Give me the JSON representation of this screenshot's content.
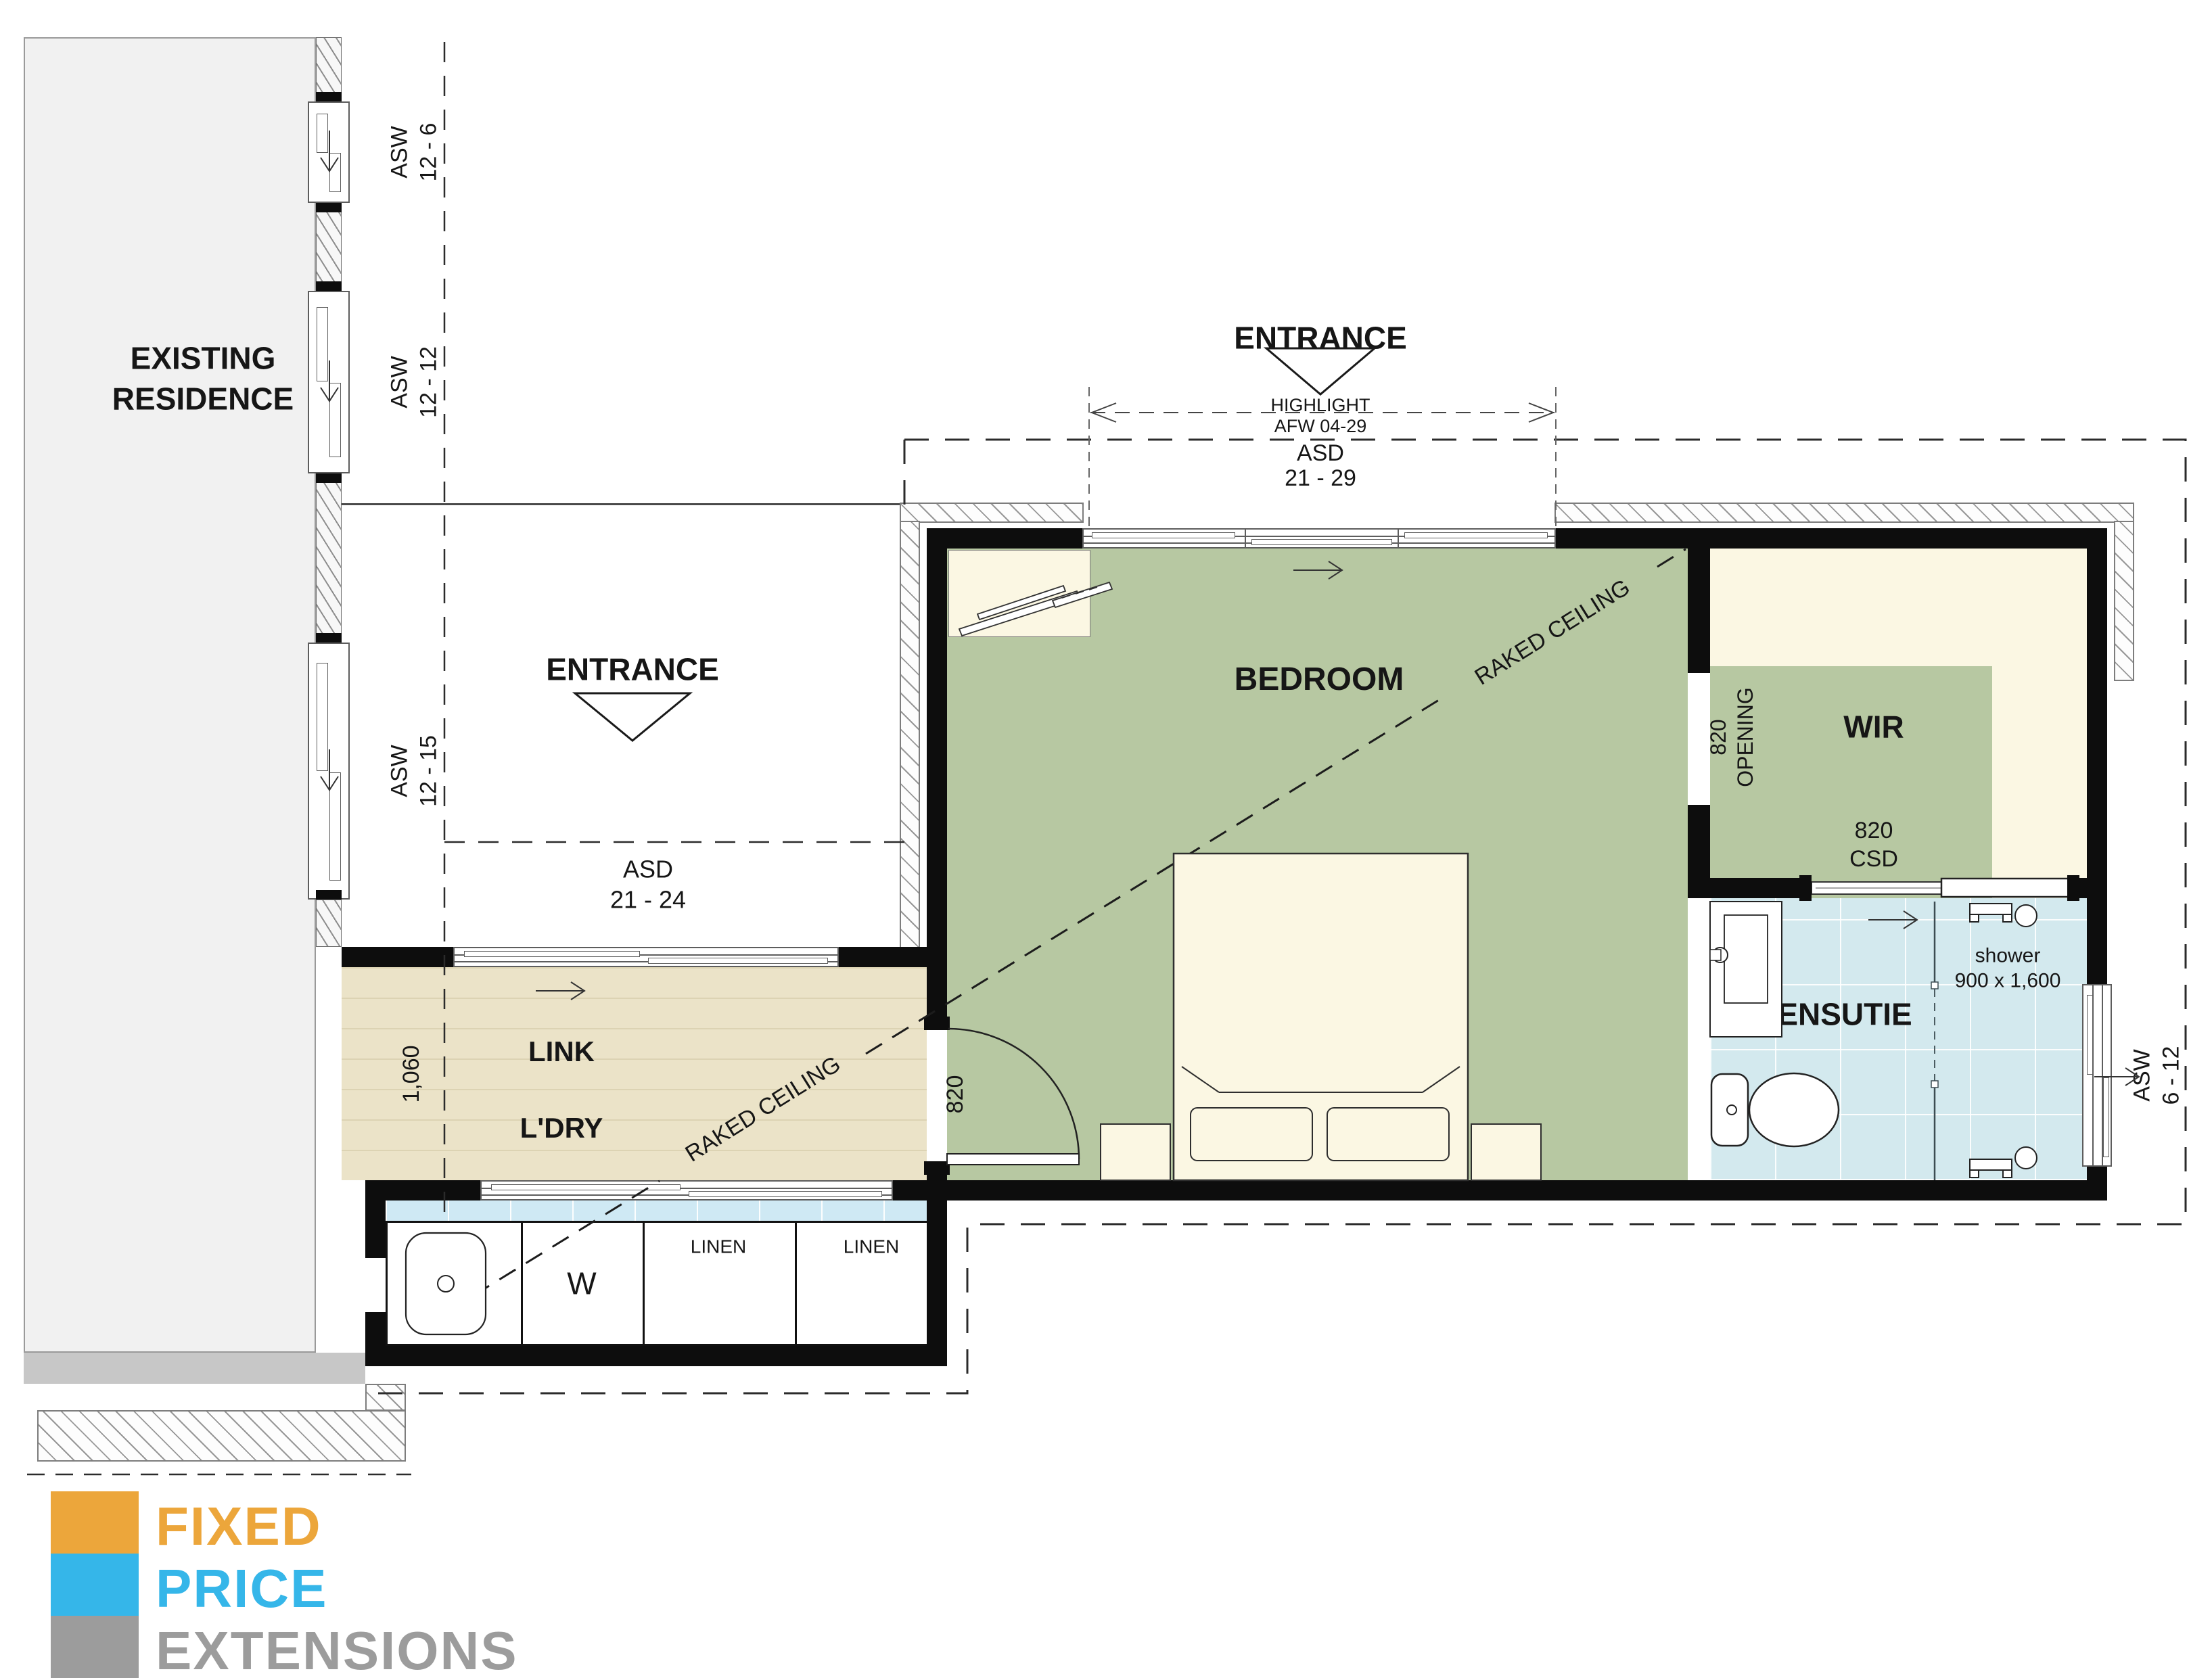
{
  "colors": {
    "bedroom_green": "#b7c8a2",
    "wir_cream": "#fbf7e3",
    "ensuite_tile": "#d3e9ee",
    "link_beige": "#ebe3c8",
    "bench_blue": "#cfe9f4",
    "wall": "#0d0d0d",
    "logo_orange": "#eca63b",
    "logo_blue": "#35b6e9",
    "logo_gray": "#9c9c9c"
  },
  "residence": {
    "line1": "EXISTING",
    "line2": "RESIDENCE"
  },
  "left_windows": [
    {
      "code": "ASW",
      "size": "12 - 6"
    },
    {
      "code": "ASW",
      "size": "12 - 12"
    },
    {
      "code": "ASW",
      "size": "12 - 15"
    }
  ],
  "courtyard": {
    "entrance": "ENTRANCE",
    "asd": "ASD",
    "asd_range": "21 - 24"
  },
  "north": {
    "entrance": "ENTRANCE",
    "highlight": "HIGHLIGHT",
    "highlight_ref": "AFW 04-29",
    "asd": "ASD",
    "asd_range": "21 - 29"
  },
  "bedroom": {
    "label": "BEDROOM",
    "bed1": "KING ZISE BED",
    "bed2": "1,830 x 2,030",
    "raked": "RAKED CEILING",
    "door": "820"
  },
  "link": {
    "label": "LINK",
    "ldry": "L'DRY",
    "width": "1,060",
    "raked": "RAKED CEILING"
  },
  "laundry": {
    "washer": "W",
    "linen1": "LINEN",
    "linen2": "LINEN"
  },
  "wir": {
    "label": "WIR",
    "open1": "820",
    "open2": "OPENING",
    "csd1": "820",
    "csd2": "CSD"
  },
  "ensuite": {
    "label": "ENSUTIE",
    "shower1": "shower",
    "shower2": "900 x 1,600",
    "win_code": "ASW",
    "win_size": "6 - 12"
  },
  "logo": {
    "l1": "FIXED",
    "l2": "PRICE",
    "l3": "EXTENSIONS"
  }
}
